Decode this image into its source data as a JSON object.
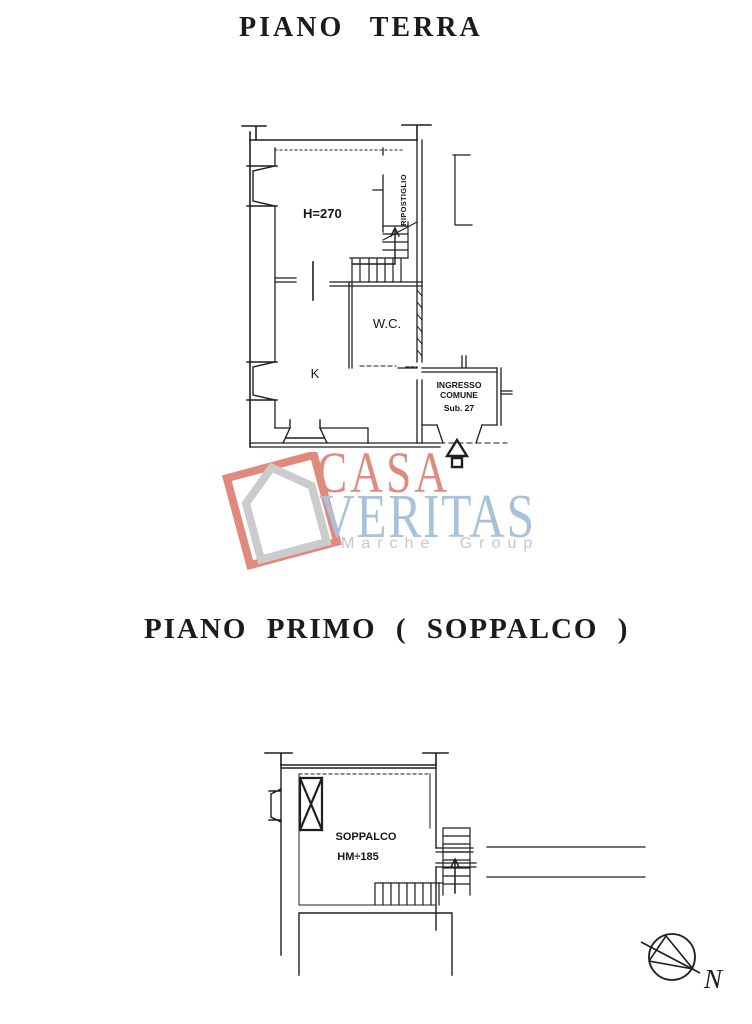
{
  "ground_floor": {
    "title": "PIANO TERRA",
    "room_height": "H=270",
    "storage": "RIPOSTIGLIO",
    "wc": "W.C.",
    "kitchen": "K",
    "entrance": {
      "line1": "INGRESSO",
      "line2": "COMUNE",
      "line3": "Sub. 27"
    }
  },
  "mezzanine": {
    "title": "PIANO PRIMO ( SOPPALCO )",
    "room": "SOPPALCO",
    "room_height": "HM÷185"
  },
  "watermark": {
    "brand_top": "CASA",
    "brand_bottom": "VERITAS",
    "tagline": "Marche Group",
    "colors": {
      "brand_top": "#df8b80",
      "brand_bottom": "#a8c2d9",
      "tagline": "#c7c7c7",
      "frame": "#e2897e",
      "house": "#cbcbcb"
    }
  },
  "compass": {
    "label": "N"
  }
}
